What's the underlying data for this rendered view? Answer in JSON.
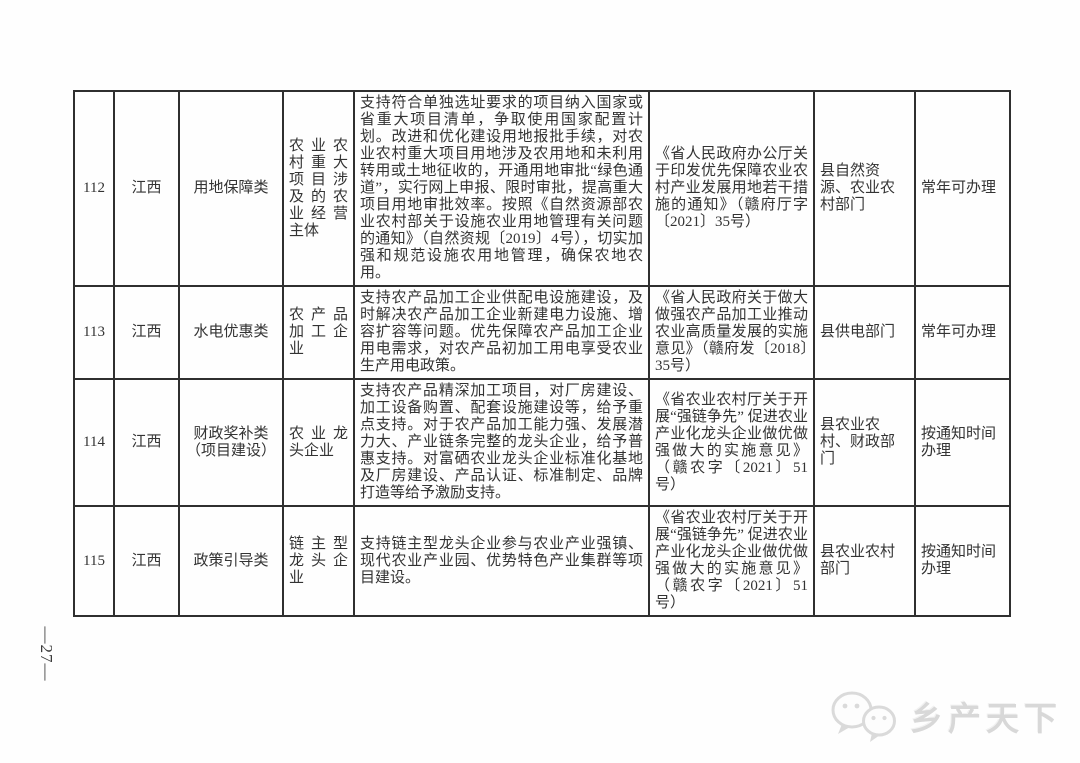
{
  "page": {
    "number_label": "—27—"
  },
  "watermark": {
    "brand": "乡产天下",
    "icon": "wechat-bubbles-icon"
  },
  "table": {
    "rows": [
      {
        "id": "112",
        "region": "江西",
        "category": "用地保障类",
        "entity": "农业农村重大项目涉及的农业经营主体",
        "description": "支持符合单独选址要求的项目纳入国家或省重大项目清单，争取使用国家配置计划。改进和优化建设用地报批手续，对农业农村重大项目用地涉及农用地和未利用转用或土地征收的，开通用地审批“绿色通道”，实行网上申报、限时审批，提高重大项目用地审批效率。按照《自然资源部农业农村部关于设施农业用地管理有关问题的通知》（自然资规〔2019〕4号），切实加强和规范设施农用地管理，确保农地农用。",
        "policy": "《省人民政府办公厅关于印发优先保障农业农村产业发展用地若干措施的通知》（赣府厅字〔2021〕35号）",
        "department": "县自然资源、农业农村部门",
        "time": "常年可办理"
      },
      {
        "id": "113",
        "region": "江西",
        "category": "水电优惠类",
        "entity": "农产品加工企业",
        "description": "支持农产品加工企业供配电设施建设，及时解决农产品加工企业新建电力设施、增容扩容等问题。优先保障农产品加工企业用电需求，对农产品初加工用电享受农业生产用电政策。",
        "policy": "《省人民政府关于做大做强农产品加工业推动农业高质量发展的实施意见》（赣府发〔2018〕35号）",
        "department": "县供电部门",
        "time": "常年可办理"
      },
      {
        "id": "114",
        "region": "江西",
        "category": "财政奖补类（项目建设）",
        "entity": "农业龙头企业",
        "description": "支持农产品精深加工项目，对厂房建设、加工设备购置、配套设施建设等，给予重点支持。对于农产品加工能力强、发展潜力大、产业链条完整的龙头企业，给予普惠支持。对富硒农业龙头企业标准化基地及厂房建设、产品认证、标准制定、品牌打造等给予激励支持。",
        "policy": "《省农业农村厅关于开展“强链争先” 促进农业产业化龙头企业做优做强做大的实施意见》（赣农字〔2021〕51号）",
        "department": "县农业农村、财政部门",
        "time": "按通知时间办理"
      },
      {
        "id": "115",
        "region": "江西",
        "category": "政策引导类",
        "entity": "链主型龙头企业",
        "description": "支持链主型龙头企业参与农业产业强镇、现代农业产业园、优势特色产业集群等项目建设。",
        "policy": "《省农业农村厅关于开展“强链争先” 促进农业产业化龙头企业做优做强做大的实施意见》（赣农字〔2021〕51号）",
        "department": "县农业农村部门",
        "time": "按通知时间办理"
      }
    ]
  }
}
